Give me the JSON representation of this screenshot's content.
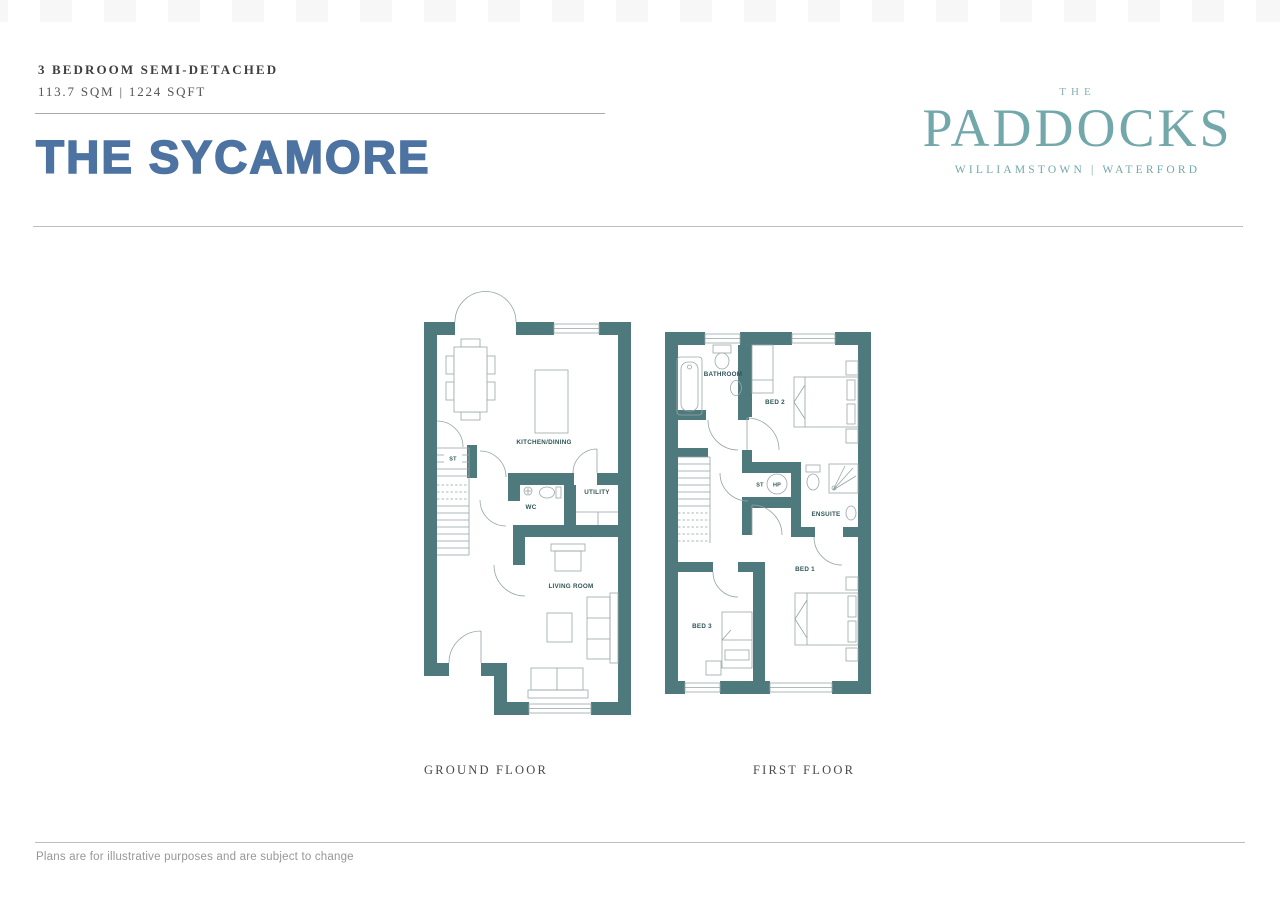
{
  "document": {
    "property_type": "3 BEDROOM SEMI-DETACHED",
    "area": "113.7 SQM | 1224 SQFT",
    "house_name": "THE SYCAMORE",
    "disclaimer": "Plans are for illustrative purposes and are subject to change"
  },
  "logo": {
    "prefix": "THE",
    "name": "PADDOCKS",
    "location": "WILLIAMSTOWN | WATERFORD"
  },
  "plans": {
    "ground": {
      "caption": "GROUND FLOOR",
      "rooms": {
        "kitchen_dining": "KITCHEN/DINING",
        "st": "ST",
        "wc": "WC",
        "utility": "UTILITY",
        "living_room": "LIVING ROOM"
      }
    },
    "first": {
      "caption": "FIRST FLOOR",
      "rooms": {
        "bathroom": "BATHROOM",
        "bed2": "BED 2",
        "st": "ST",
        "hp": "HP",
        "ensuite": "ENSUITE",
        "bed1": "BED 1",
        "bed3": "BED 3"
      }
    }
  },
  "colors": {
    "wall_teal": "#4E7A7E",
    "accent_blue": "#4C73A1",
    "logo_teal": "#73A8AA"
  }
}
